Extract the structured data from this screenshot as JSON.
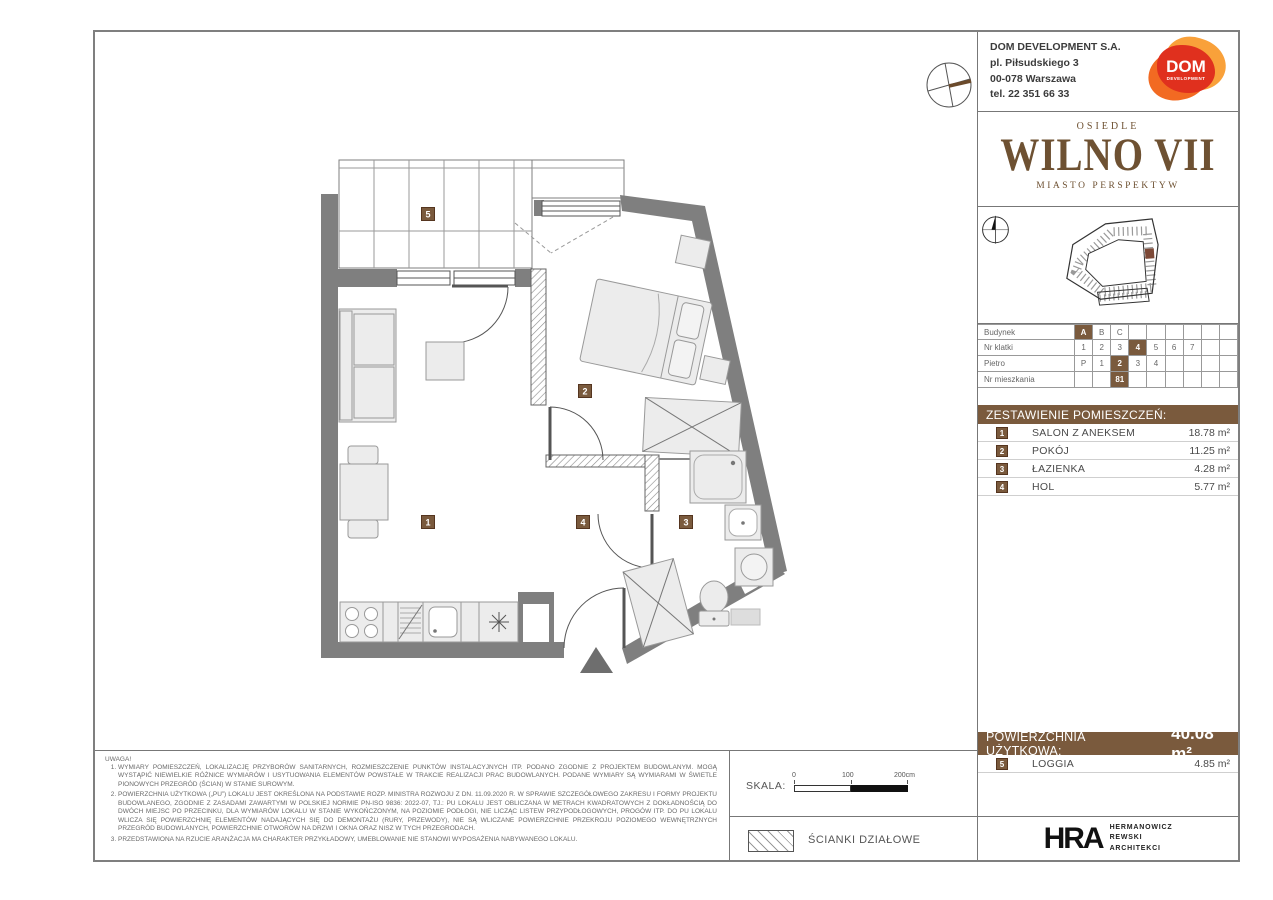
{
  "accent_color": "#7a5a3d",
  "company": {
    "name": "DOM DEVELOPMENT S.A.",
    "address_line1": "pl. Piłsudskiego 3",
    "address_line2": "00-078 Warszawa",
    "phone": "tel. 22 351 66 33",
    "logo_word": "DOM",
    "logo_sub": "DEVELOPMENT"
  },
  "brand": {
    "estate_label": "OSIEDLE",
    "estate_name": "WILNO VII",
    "tagline": "MIASTO PERSPEKTYW"
  },
  "unit_selector": {
    "rows": [
      {
        "label": "Budynek",
        "cells": [
          "A",
          "B",
          "C",
          "",
          "",
          "",
          "",
          "",
          ""
        ]
      },
      {
        "label": "Nr klatki",
        "cells": [
          "1",
          "2",
          "3",
          "4",
          "5",
          "6",
          "7",
          "",
          ""
        ]
      },
      {
        "label": "Pietro",
        "cells": [
          "P",
          "1",
          "2",
          "3",
          "4",
          "",
          "",
          "",
          ""
        ]
      },
      {
        "label": "Nr mieszkania",
        "cells": [
          "",
          "",
          "81",
          "",
          "",
          "",
          "",
          "",
          ""
        ]
      }
    ]
  },
  "rooms": {
    "header": "ZESTAWIENIE POMIESZCZEŃ:",
    "items": [
      {
        "no": "1",
        "name": "SALON Z ANEKSEM",
        "area": "18.78 m²"
      },
      {
        "no": "2",
        "name": "POKÓJ",
        "area": "11.25 m²"
      },
      {
        "no": "3",
        "name": "ŁAZIENKA",
        "area": "4.28 m²"
      },
      {
        "no": "4",
        "name": "HOL",
        "area": "5.77 m²"
      }
    ]
  },
  "totals": {
    "label": "POWIERZCHNIA UŻYTKOWA:",
    "value": "40.08 m²",
    "loggia": {
      "no": "5",
      "name": "LOGGIA",
      "area": "4.85 m²"
    }
  },
  "plan": {
    "room_labels": {
      "salon": "1",
      "pokoj": "2",
      "lazienka": "3",
      "hol": "4",
      "loggia": "5"
    }
  },
  "notes": {
    "title": "UWAGA!",
    "items": [
      "WYMIARY POMIESZCZEŃ, LOKALIZACJĘ PRZYBORÓW SANITARNYCH, ROZMIESZCZENIE PUNKTÓW INSTALACYJNYCH ITP. PODANO ZGODNIE Z PROJEKTEM BUDOWLANYM. MOGĄ WYSTĄPIĆ NIEWIELKIE RÓŻNICE WYMIARÓW I USYTUOWANIA ELEMENTÓW POWSTAŁE W TRAKCIE REALIZACJI PRAC BUDOWLANYCH. PODANE WYMIARY SĄ WYMIARAMI W ŚWIETLE PIONOWYCH PRZEGRÓD (ŚCIAN) W STANIE SUROWYM.",
      "POWIERZCHNIA UŻYTKOWA („PU”) LOKALU JEST OKREŚLONA NA PODSTAWIE ROZP. MINISTRA ROZWOJU Z DN. 11.09.2020 R. W SPRAWIE SZCZEGÓŁOWEGO ZAKRESU I FORMY PROJEKTU BUDOWLANEGO, ZGODNIE Z ZASADAMI ZAWARTYMI W POLSKIEJ NORMIE PN-ISO 9836: 2022-07, TJ.: PU LOKALU JEST OBLICZANA W METRACH KWADRATOWYCH Z DOKŁADNOŚCIĄ DO DWÓCH MIEJSC PO PRZECINKU, DLA WYMIARÓW LOKALU W STANIE WYKOŃCZONYM, NA POZIOMIE PODŁOGI, NIE LICZĄC LISTEW PRZYPODŁOGOWYCH, PROGÓW ITP. DO PU LOKALU WLICZA SIĘ POWIERZCHNIĘ ELEMENTÓW NADAJĄCYCH SIĘ DO DEMONTAŻU (RURY, PRZEWODY), NIE SĄ WLICZANE POWIERZCHNIE PRZEKROJU POZIOMEGO WEWNĘTRZNYCH PRZEGRÓD BUDOWLANYCH, POWIERZCHNIE OTWORÓW NA DRZWI I OKNA ORAZ NISZ W TYCH PRZEGRODACH.",
      "PRZEDSTAWIONA NA RZUCIE ARANŻACJA MA CHARAKTER PRZYKŁADOWY, UMEBLOWANIE NIE STANOWI WYPOSAŻENIA NABYWANEGO LOKALU."
    ]
  },
  "scale": {
    "label": "SKALA:",
    "tick0": "0",
    "tick100": "100",
    "tick200": "200cm"
  },
  "legend": {
    "partition_walls": "ŚCIANKI DZIAŁOWE"
  },
  "architect": {
    "logo": "HRA",
    "name_line1": "HERMANOWICZ",
    "name_line2": "REWSKI",
    "name_line3": "ARCHITEKCI"
  }
}
